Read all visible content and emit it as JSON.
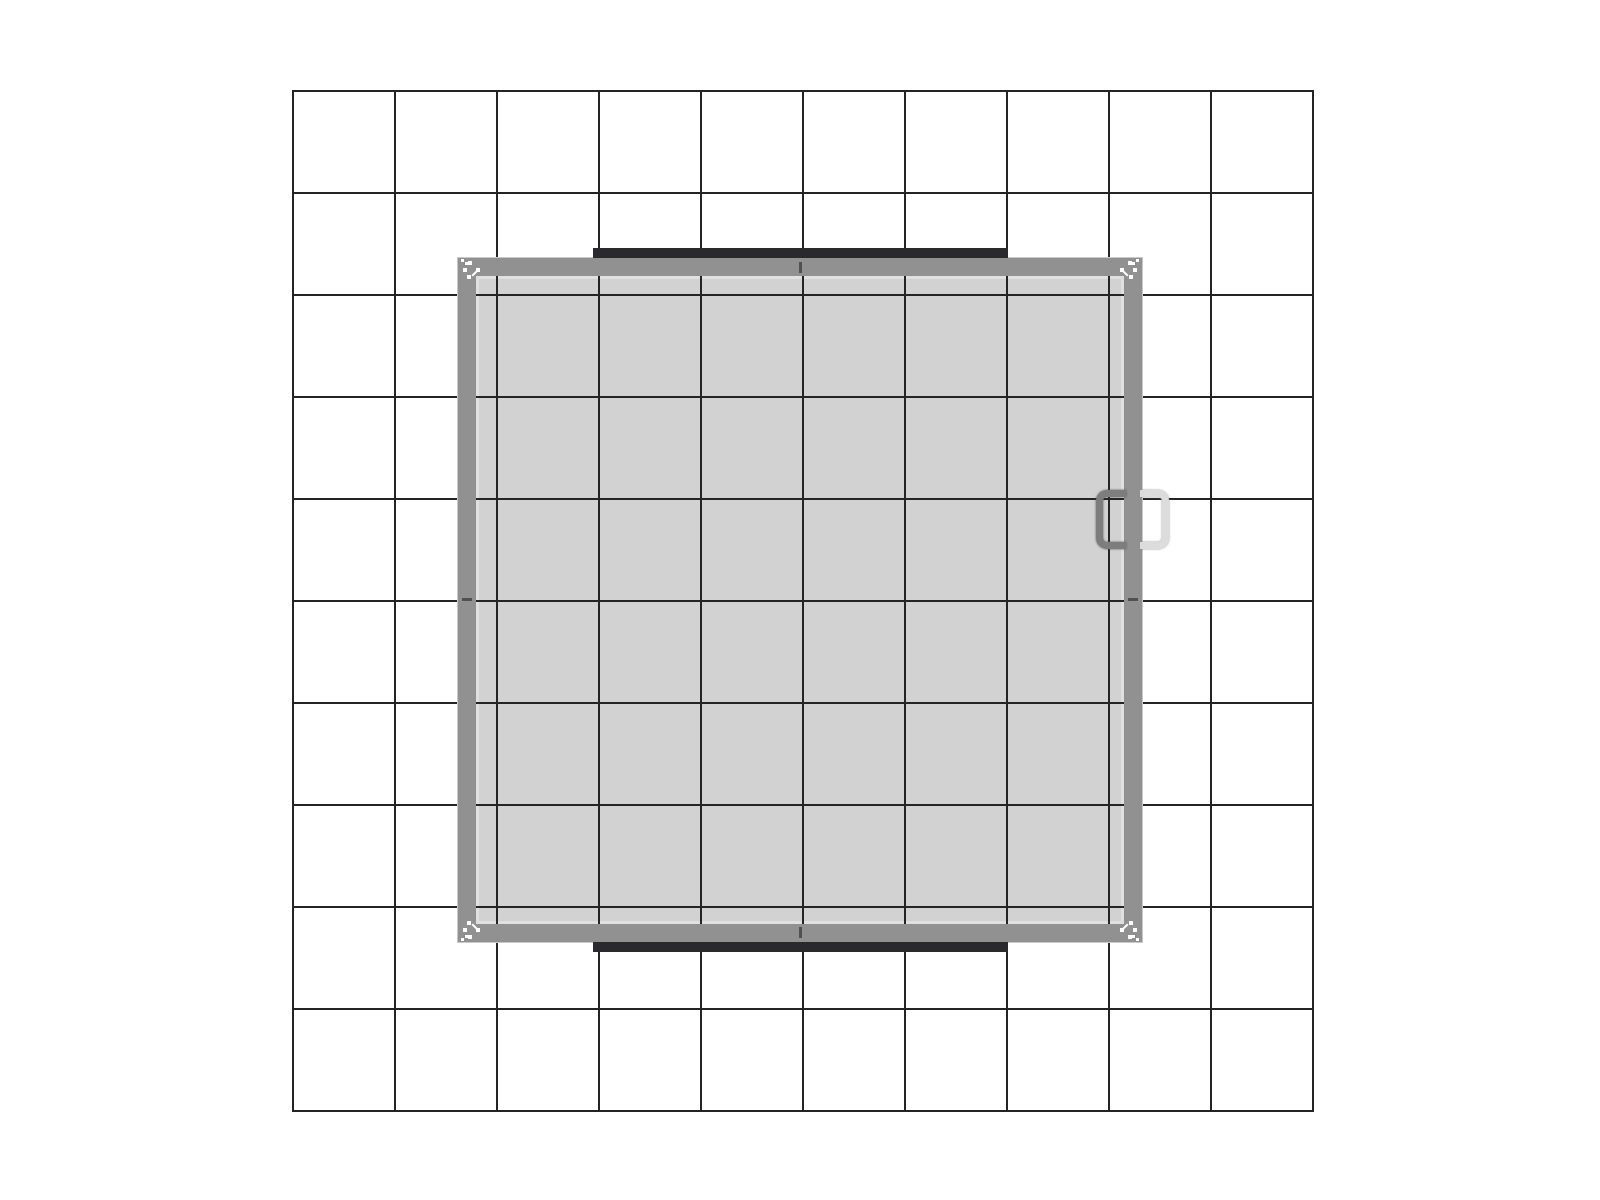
{
  "meta": {
    "kind": "technical-plan-drawing",
    "description": "Top-down plan view of a square exhibit structure centered on a 10 x 10 square reference grid; no text labels are present in the drawing"
  },
  "css_vars": {
    "bg": "#ffffff",
    "grid-line": "#242424",
    "frame-color": "#919191",
    "frame-halo": "#c9c9c9",
    "fill-color": "#d2d2d2",
    "fill-edge": "#e0e0e0",
    "bar-color": "#2a2a2c",
    "seam-color": "#515151",
    "handle-dark": "#7d7d7d",
    "handle-light": "#dcdcdc",
    "marker-color": "#ffffff"
  },
  "scene": {
    "grid": {
      "columns": 10,
      "rows": 10,
      "cell_px": 102,
      "line_px": 2,
      "line_color": "#242424"
    },
    "structure": {
      "shape": "square",
      "outer_px": 684,
      "frame_thickness_px": 18,
      "frame_color": "#919191",
      "floor_color": "#d2d2d2",
      "centered_on_grid": true,
      "seam_ticks": [
        "top-center",
        "bottom-center",
        "left-center",
        "right-center"
      ],
      "header_bars": [
        {
          "side": "top",
          "length_px": 415,
          "thickness_px": 10,
          "color": "#2a2a2c"
        },
        {
          "side": "bottom",
          "length_px": 415,
          "thickness_px": 10,
          "color": "#2a2a2c"
        }
      ],
      "door_handles": [
        {
          "side": "right-inside",
          "color": "#7d7d7d",
          "height_px": 59
        },
        {
          "side": "right-outside",
          "color": "#dcdcdc",
          "height_px": 59
        }
      ],
      "corner_fastener_clusters": 4
    },
    "corner_marker": {
      "dots": [
        {
          "x": 3,
          "y": 1,
          "s": 3
        },
        {
          "x": 7,
          "y": 4,
          "s": 3
        },
        {
          "x": 10,
          "y": 3,
          "s": 4
        },
        {
          "x": 5,
          "y": 10,
          "s": 4
        },
        {
          "x": 18,
          "y": 10,
          "s": 4
        },
        {
          "x": 9,
          "y": 17,
          "s": 4
        }
      ],
      "slashes": [
        {
          "x": 13,
          "y": 14,
          "w": 8,
          "h": 2,
          "rot": -45
        }
      ]
    }
  }
}
